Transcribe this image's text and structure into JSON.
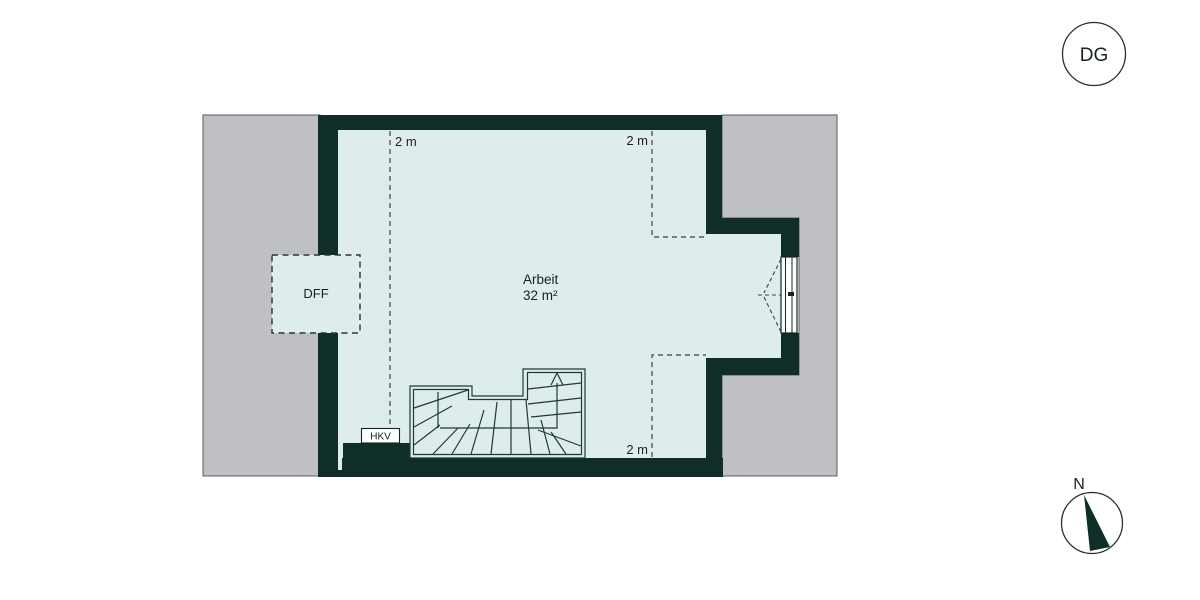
{
  "floor_badge": {
    "label": "DG"
  },
  "compass": {
    "label": "N"
  },
  "room": {
    "name": "Arbeit",
    "area": "32 m²"
  },
  "height_lines": {
    "left": "2 m",
    "top_right": "2 m",
    "bottom_right": "2 m"
  },
  "features": {
    "roof_window": "DFF",
    "heating_manifold": "HKV"
  },
  "colors": {
    "wall": "#0f2e27",
    "floor": "#deedeb",
    "roof": "#bfc0c3",
    "line": "#1f3a34"
  }
}
